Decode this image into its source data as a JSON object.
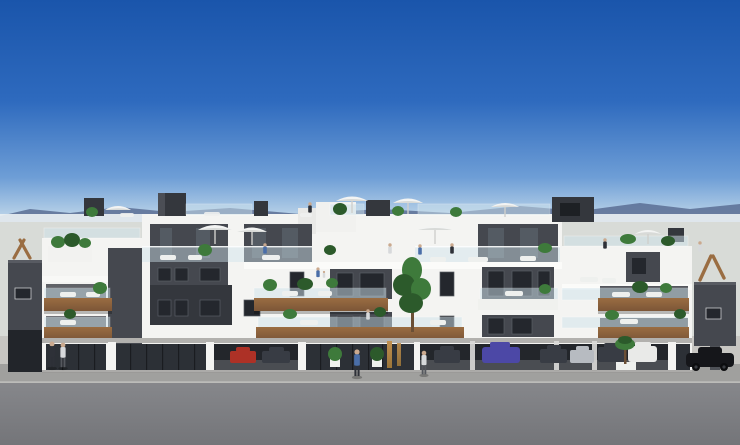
{
  "scene": {
    "title": "New-build apartment complex — exterior 3D render",
    "description": "Architectural rendering of a modern three-storey white apartment building with dark grey window panels, wooden balcony fascias with glass balustrades, rooftop terraces with white parasols, plants and tiny people, ground-floor glass lobby with gold vertical signage, open parking bays with cars underneath, and a grey asphalt street in the foreground under a clear blue sky with a hazy mountain horizon.",
    "sky": "clear blue sky, hazy at horizon",
    "horizon": "distant blue-grey mountains and haze",
    "building": "white apartment block, dark grey accents, wood balcony bands",
    "rooftop": "roof terraces with parasols, glass railings, plants, stair towers",
    "ground_floor": "glass lobby, storefronts and open car park",
    "street": "pale concrete apron, paver sidewalk, asphalt road",
    "signage_note": "illegible gold vertical lettering beside entrance"
  },
  "colors": {
    "sky_top": "#1a55ab",
    "sky_mid": "#2e6abe",
    "sky_low": "#6e9ed6",
    "sky_horizon": "#c2d8ea",
    "haze": "#e9eff2",
    "mountain": "#55688f",
    "distant": "#d8dbd7",
    "wall_white": "#f4f4f2",
    "wall_tint": "#e7e8e6",
    "dark_panel": "#45484f",
    "darker_panel": "#34373d",
    "window_glass": "#24272d",
    "glass_reflect": "#8fa0ac",
    "storefront": "#2c3036",
    "garage": "#23262b",
    "garage_floor": "#4a4d52",
    "rail_glass": "#cfe3ec",
    "wood": "#7c5637",
    "wood_light": "#9a6d42",
    "slab": "#fbfbf9",
    "apron": "#c7c6c2",
    "paver": "#a0a09e",
    "road": "#86878b",
    "road_dark": "#747579",
    "curb": "#b9b9b6",
    "plant": "#3e7a3b",
    "plant_dark": "#2c5a2b",
    "trunk": "#6b4f35",
    "umbrella": "#f3f4f3",
    "umbrella_shade": "#d8dad8",
    "gold": "#c09050",
    "gold_dark": "#9a7438",
    "car_red": "#ad3126",
    "car_purple": "#4c48a6",
    "car_dark": "#383c44",
    "car_silver": "#b7bbc1",
    "car_white": "#e9eae8",
    "car_black": "#15161a",
    "figure_dark": "#2e3138",
    "figure_light": "#d7d9db",
    "figure_blue": "#4a6ea8",
    "furniture": "#eef0ee",
    "shadow": "rgba(0,0,0,0.25)"
  }
}
